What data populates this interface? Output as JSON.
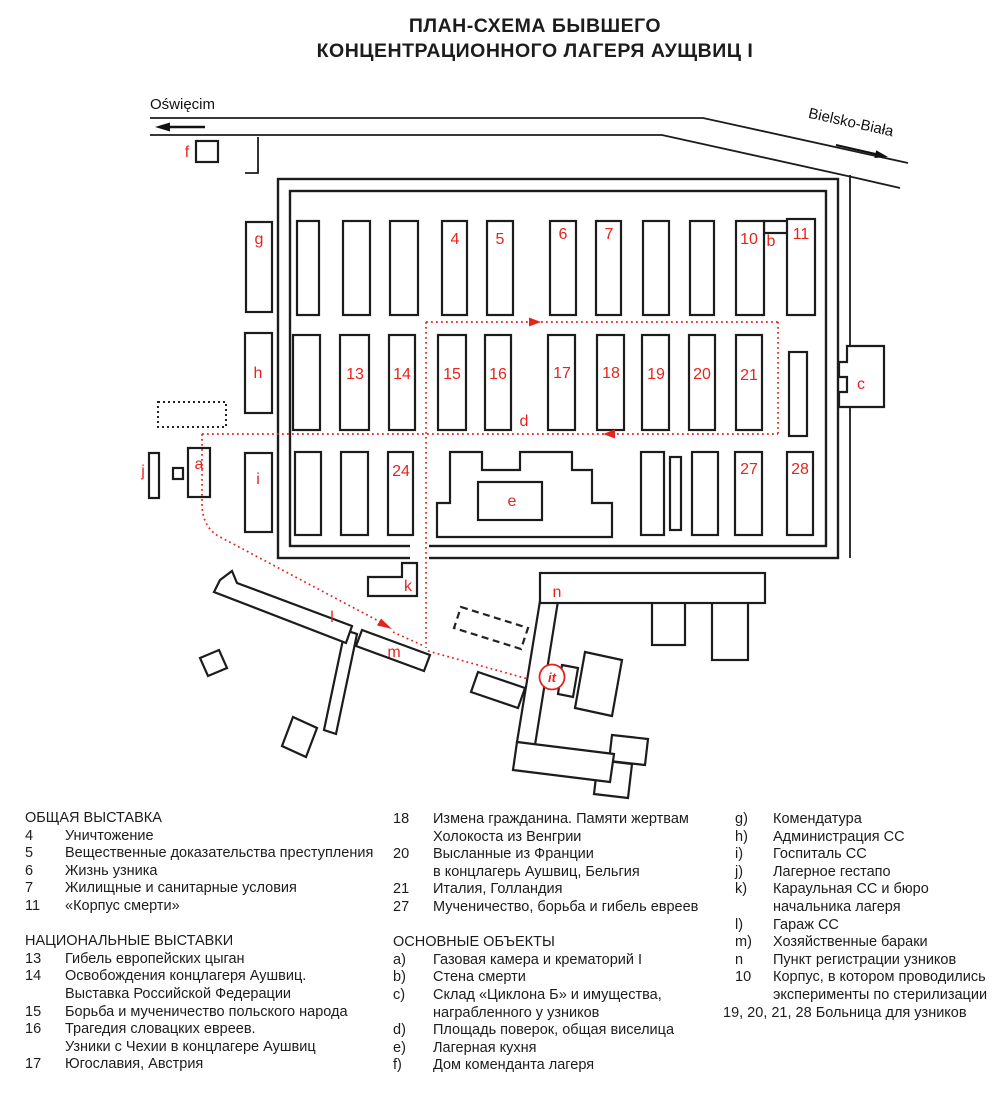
{
  "title": {
    "line1": "ПЛАН-СХЕМА БЫВШЕГО",
    "line2": "КОНЦЕНТРАЦИОННОГО ЛАГЕРЯ АУЩВИЦ I"
  },
  "colors": {
    "label_red": "#e8231d",
    "ink": "#1c1c1c"
  },
  "map": {
    "roads": {
      "left": "Oświęcim",
      "right": "Bielsko-Biała"
    },
    "labels": {
      "g": "g",
      "b4": "4",
      "b5": "5",
      "b6": "6",
      "b7": "7",
      "b10": "10",
      "b": "b",
      "b11": "11",
      "h": "h",
      "b13": "13",
      "b14": "14",
      "b15": "15",
      "b16": "16",
      "b17": "17",
      "b18": "18",
      "b19": "19",
      "b20": "20",
      "b21": "21",
      "c": "c",
      "d": "d",
      "j": "j",
      "a": "a",
      "i": "i",
      "b24": "24",
      "e": "e",
      "b27": "27",
      "b28": "28",
      "f": "f",
      "k": "k",
      "l": "l",
      "m": "m",
      "n": "n",
      "it": "it"
    }
  },
  "legend": {
    "col1": [
      {
        "text": "ОБЩАЯ ВЫСТАВКА",
        "flush": true
      },
      {
        "num": "4",
        "text": "Уничтожение"
      },
      {
        "num": "5",
        "text": "Вещественные доказательства преступления"
      },
      {
        "num": "6",
        "text": "Жизнь узника"
      },
      {
        "num": "7",
        "text": "Жилищные и санитарные условия"
      },
      {
        "num": "11",
        "text": "«Корпус смерти»"
      },
      {
        "text": "",
        "flush": true
      },
      {
        "text": "НАЦИОНАЛЬНЫЕ ВЫСТАВКИ",
        "flush": true
      },
      {
        "num": "13",
        "text": "Гибель европейских цыган"
      },
      {
        "num": "14",
        "text": "Освобождения концлагеря Аушвиц."
      },
      {
        "text": "Выставка Российской Федерации"
      },
      {
        "num": "15",
        "text": "Борьба и мученичество польского народа"
      },
      {
        "num": "16",
        "text": "Трагедия словацких евреев."
      },
      {
        "text": "Узники с Чехии в концлагере Аушвиц"
      },
      {
        "num": "17",
        "text": "Югославия, Австрия"
      }
    ],
    "col2": [
      {
        "num": "18",
        "text": "Измена гражданина. Памяти жертвам"
      },
      {
        "text": "Холокоста из Венгрии"
      },
      {
        "num": "20",
        "text": "Высланные из Франции"
      },
      {
        "text": "в концлагерь Аушвиц, Бельгия"
      },
      {
        "num": "21",
        "text": "Италия, Голландия"
      },
      {
        "num": "27",
        "text": "Мученичество, борьба и гибель евреев"
      },
      {
        "text": "",
        "flush": true
      },
      {
        "text": "ОСНОВНЫЕ ОБЪЕКТЫ",
        "flush": true
      },
      {
        "num": "a)",
        "text": "Газовая камера и крематорий I"
      },
      {
        "num": "b)",
        "text": "Стена смерти"
      },
      {
        "num": "c)",
        "text": "Склад «Циклона Б» и имущества,"
      },
      {
        "text": "награбленного у узников"
      },
      {
        "num": "d)",
        "text": "Площадь поверок, общая виселица"
      },
      {
        "num": "e)",
        "text": "Лагерная кухня"
      },
      {
        "num": "f)",
        "text": "Дом коменданта лагеря"
      }
    ],
    "col3": [
      {
        "num": "g)",
        "text": "Комендатура"
      },
      {
        "num": "h)",
        "text": "Администрация СС"
      },
      {
        "num": "i)",
        "text": "Госпиталь СС"
      },
      {
        "num": "j)",
        "text": "Лагерное гестапо"
      },
      {
        "num": "k)",
        "text": "Караульная СС и бюро"
      },
      {
        "text": "начальника лагеря"
      },
      {
        "num": "l)",
        "text": "Гараж СС"
      },
      {
        "num": "m)",
        "text": "Хозяйственные бараки"
      },
      {
        "num": "n",
        "text": "Пункт регистрации узников"
      },
      {
        "num": "10",
        "text": "Корпус, в котором проводились"
      },
      {
        "text": "эксперименты по стерилизации"
      },
      {
        "text": "19, 20, 21, 28 Больница для узников",
        "flush": true
      }
    ]
  }
}
